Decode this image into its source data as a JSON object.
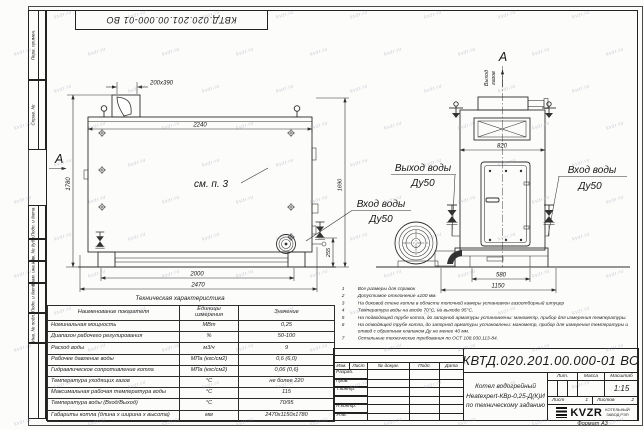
{
  "frame": {
    "top_stamp_number": "КВТД.020.201.00.000-01 ВО",
    "left_labels": [
      "Перв. примен.",
      "Справ. №",
      "Подп. и дата",
      "Инв. № дубл.",
      "Взам. инв. №",
      "Подп. и дата",
      "Инв. № подл."
    ]
  },
  "views": {
    "side": {
      "section_label": "А",
      "see_note": "см. п. 3",
      "inlet_label": [
        "Вход воды",
        "Ду50"
      ],
      "dims": {
        "duct": "200х390",
        "width_top": "2240",
        "height_total": "1780",
        "height_body": "1690",
        "stub_height": "255",
        "support_span": "2000",
        "length_total": "2470"
      }
    },
    "front": {
      "section_label": "А",
      "flow_label_lines": [
        "Выход",
        "газов"
      ],
      "outlet_label": [
        "Выход воды",
        "Ду50"
      ],
      "inlet_label": [
        "Вход воды",
        "Ду50"
      ],
      "dims": {
        "width": "820",
        "base_width": "580",
        "base_total": "1150"
      }
    }
  },
  "notes": [
    "Все размеры для справок",
    "Допустимое отклонение ±100 мм.",
    "На боковой стене котла в области топочной камеры установлен газоотборный штуцер",
    "Температура воды на входе 70°С, на выходе 95°С.",
    "На подводящей трубе котла, до запорной арматуры установлены: манометр, прибор для измерения температуры.",
    "На отводящей трубе котла, до запорной арматуры установлены: манометр, прибор для измерения температуры и отвод с обратным клапаном Ду не менее 40 мм.",
    "Остальные технические требования по ОСТ 108.030.113-84."
  ],
  "table": {
    "caption": "Техническая характеристика",
    "headers": [
      "Наименование показателя",
      "Единицы измерения",
      "Значение"
    ],
    "rows": [
      [
        "Номинальная мощность",
        "МВт",
        "0,25"
      ],
      [
        "Диапазон рабочего регулирования",
        "%",
        "50-100"
      ],
      [
        "Расход воды",
        "м3/ч",
        "9"
      ],
      [
        "Рабочее давление воды",
        "МПа (кгс/см2)",
        "0,6 (6,0)"
      ],
      [
        "Гидравлическое сопротивление котла",
        "МПа (кгс/см2)",
        "0,06 (0,6)"
      ],
      [
        "Температура уходящих газов",
        "°С",
        "не более 220"
      ],
      [
        "Максимальная рабочая температура воды",
        "°С",
        "115"
      ],
      [
        "Температура воды (Вход/Выход)",
        "°С",
        "70/95"
      ],
      [
        "Габариты котла (длина х ширина х высота)",
        "мм",
        "2470х1150х1780"
      ]
    ]
  },
  "titleblock": {
    "doc_number": "КВТД.020.201.00.000-01 ВО",
    "title_lines": [
      "Котел водогрейный",
      "Heatexpert-КВр-0,25-Д(К)И",
      "по техническому заданию"
    ],
    "headers": {
      "lit": "Лит.",
      "mass": "Масса",
      "scale": "Масштаб"
    },
    "scale_value": "1:15",
    "sheet_label": "Лист",
    "sheet_value": "1",
    "sheets_label": "Листов",
    "sheets_value": "2",
    "change_header": [
      "Изм.",
      "Лист",
      "№ докум.",
      "Подп.",
      "Дата"
    ],
    "rows_left": [
      "Разраб.",
      "Пров.",
      "Т.контр.",
      "",
      "Н.контр.",
      "Утв."
    ],
    "logo": {
      "text": "KVZR",
      "sub": [
        "КОТЕЛЬНЫЙ",
        "ЗАВОД РЭП"
      ]
    },
    "format_label": "Формат А3"
  },
  "watermark": {
    "text": "kvzr.ru"
  }
}
